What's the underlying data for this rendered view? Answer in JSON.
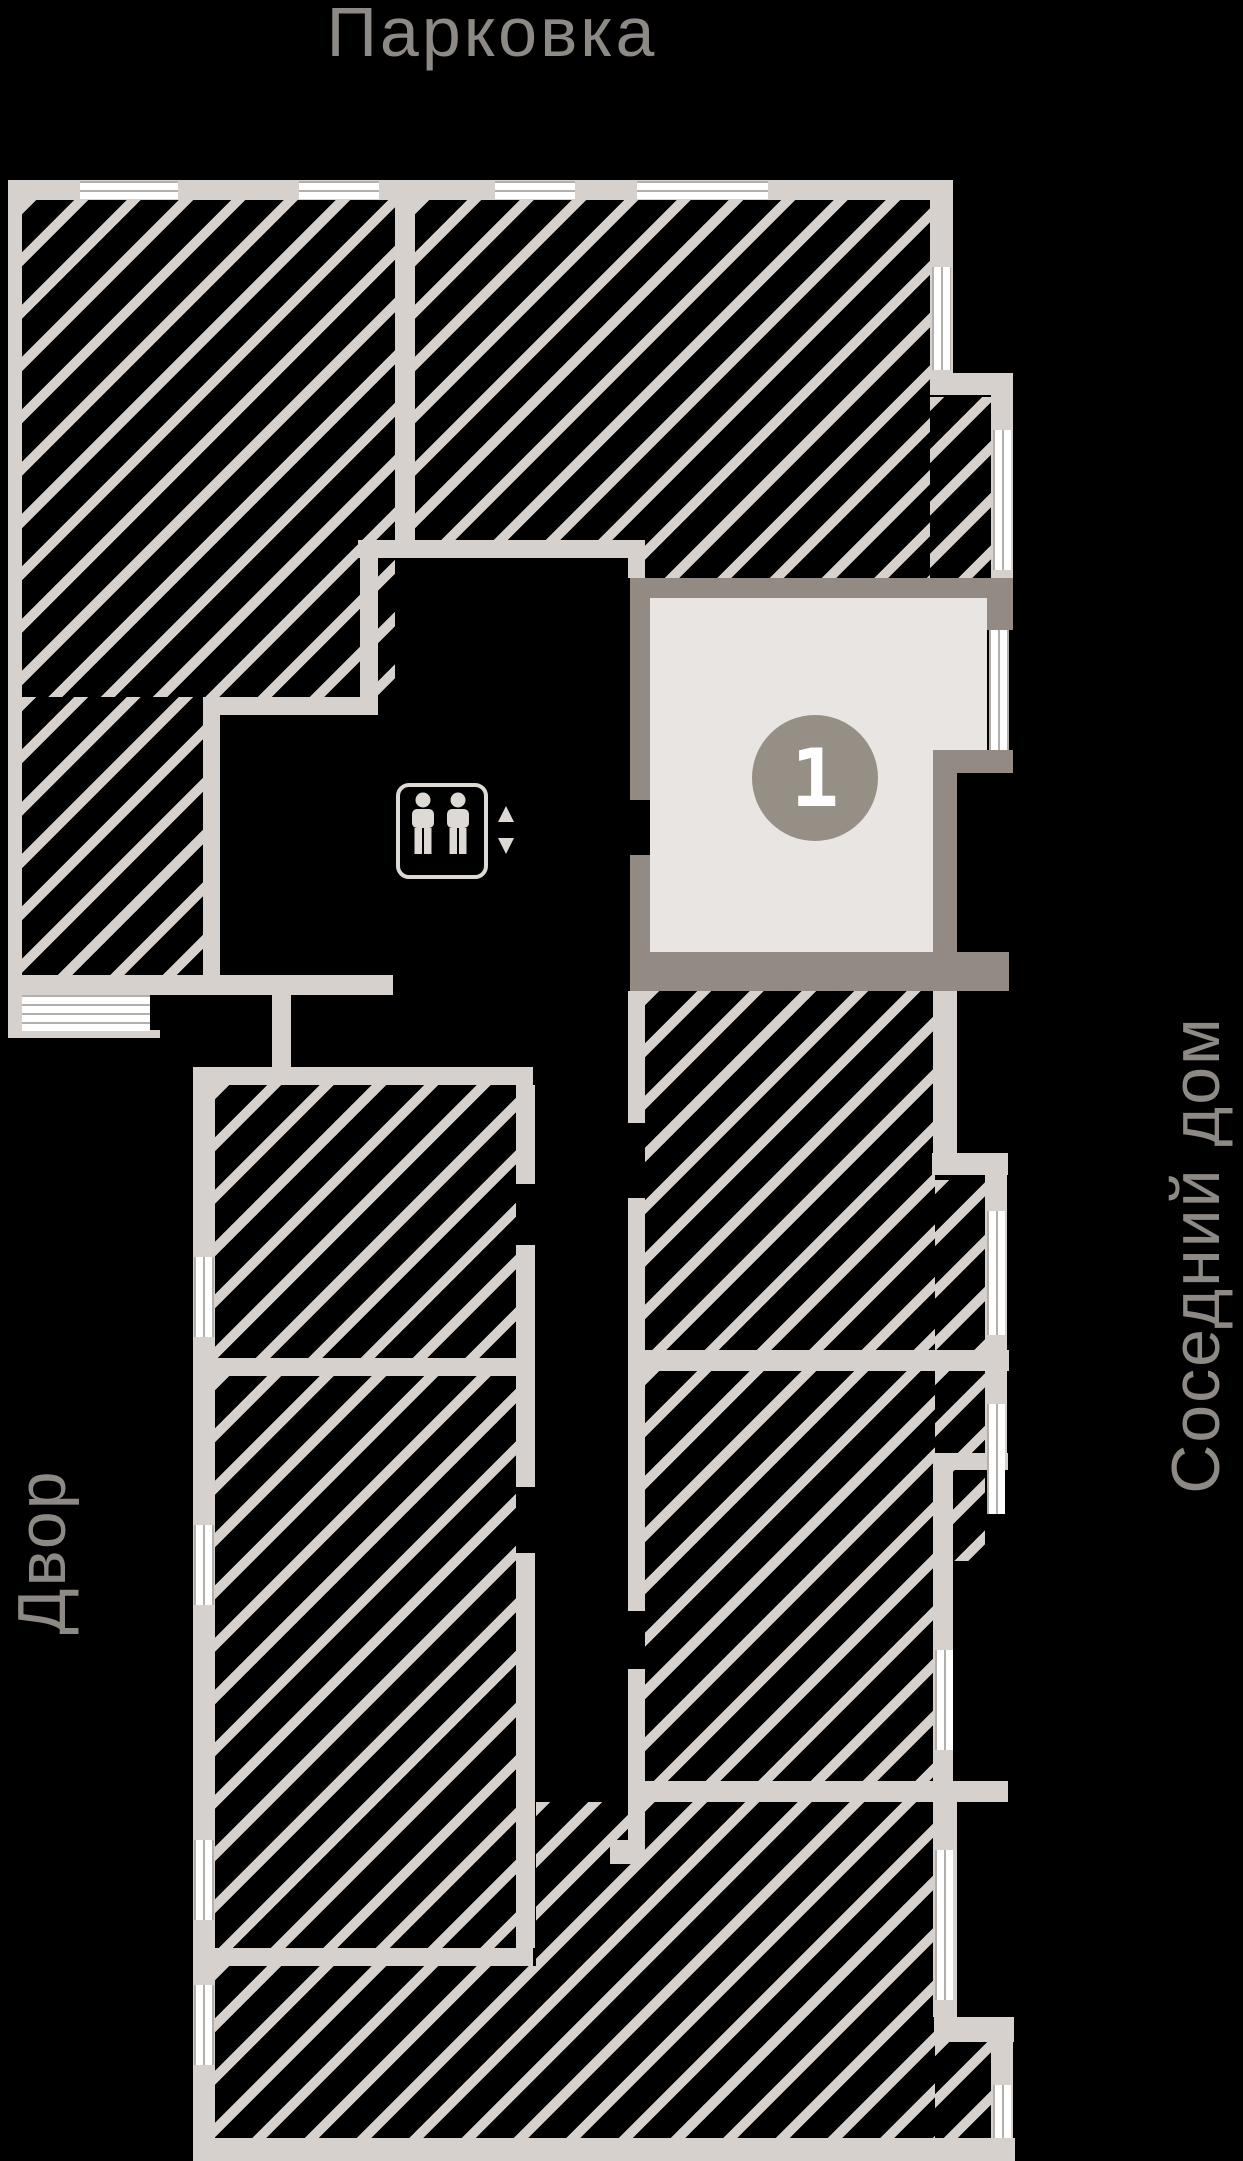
{
  "page": {
    "background_color": "#000000",
    "type": "floor-plan apartment selector"
  },
  "labels": {
    "top": "Парковка",
    "right": "Соседний дом",
    "left": "Двор"
  },
  "apartment": {
    "number": "1",
    "status": "available",
    "fill_color": "#e8e5e2",
    "wall_color": "#938b83",
    "badge_color": "#968f86",
    "badge_text_color": "#ffffff"
  },
  "colors": {
    "wall": "#d6d1cd",
    "hatch_line": "#d6d1cd",
    "window_glass": "#ffffff",
    "window_line": "#b3afab",
    "label_text": "#8d8984",
    "background": "#000000"
  },
  "icons": {
    "elevator": "elevator-people-icon",
    "elevator_arrows": "up-down-arrows-icon"
  }
}
